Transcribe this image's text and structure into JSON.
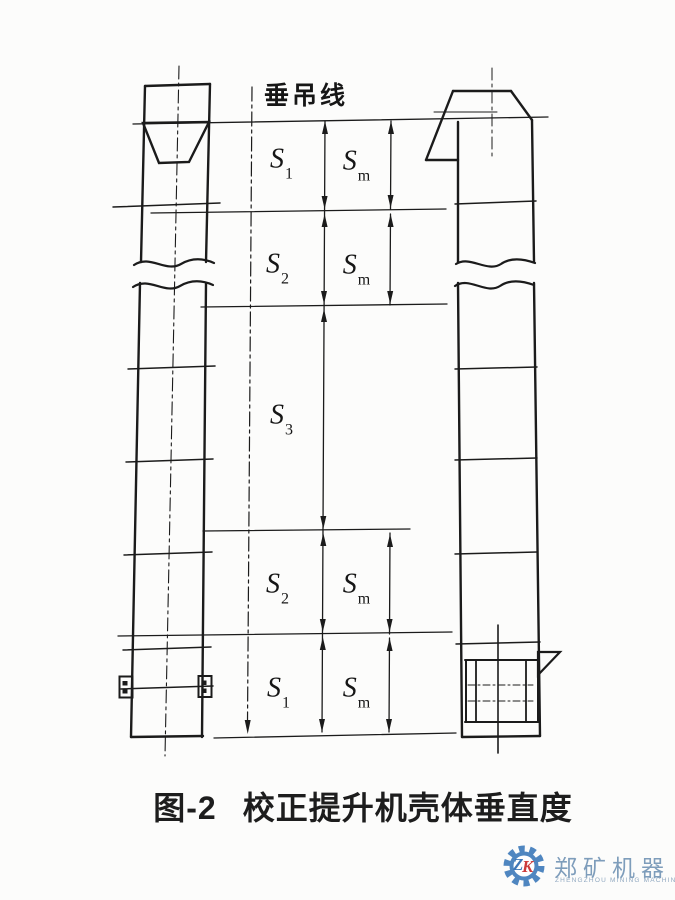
{
  "figure": {
    "plumb_label": "垂吊线",
    "caption_no": "图-2",
    "caption": "校正提升机壳体垂直度"
  },
  "dims": {
    "s1_top": {
      "base": "S",
      "sub": "1"
    },
    "sm_top": {
      "base": "S",
      "sub": "m"
    },
    "s2_top": {
      "base": "S",
      "sub": "2"
    },
    "sm_upper": {
      "base": "S",
      "sub": "m"
    },
    "s3": {
      "base": "S",
      "sub": "3"
    },
    "s2_bottom": {
      "base": "S",
      "sub": "2"
    },
    "sm_lower": {
      "base": "S",
      "sub": "m"
    },
    "s1_bottom": {
      "base": "S",
      "sub": "1"
    },
    "sm_bottom": {
      "base": "S",
      "sub": "m"
    }
  },
  "logo": {
    "letter_z": "Z",
    "letter_k": "K",
    "company_cn": "郑矿机器",
    "company_en": "ZHENGZHOU MINING MACHINERY"
  },
  "icons": {
    "logo_gear": "gear"
  },
  "colors": {
    "line": "#1b1b1b",
    "logo_blue": "#4f86c0",
    "logo_letter_blue": "#3f78b8",
    "logo_red": "#cc3a3a",
    "logo_text": "#7e9dbb",
    "paper": "#fcfcfb"
  }
}
